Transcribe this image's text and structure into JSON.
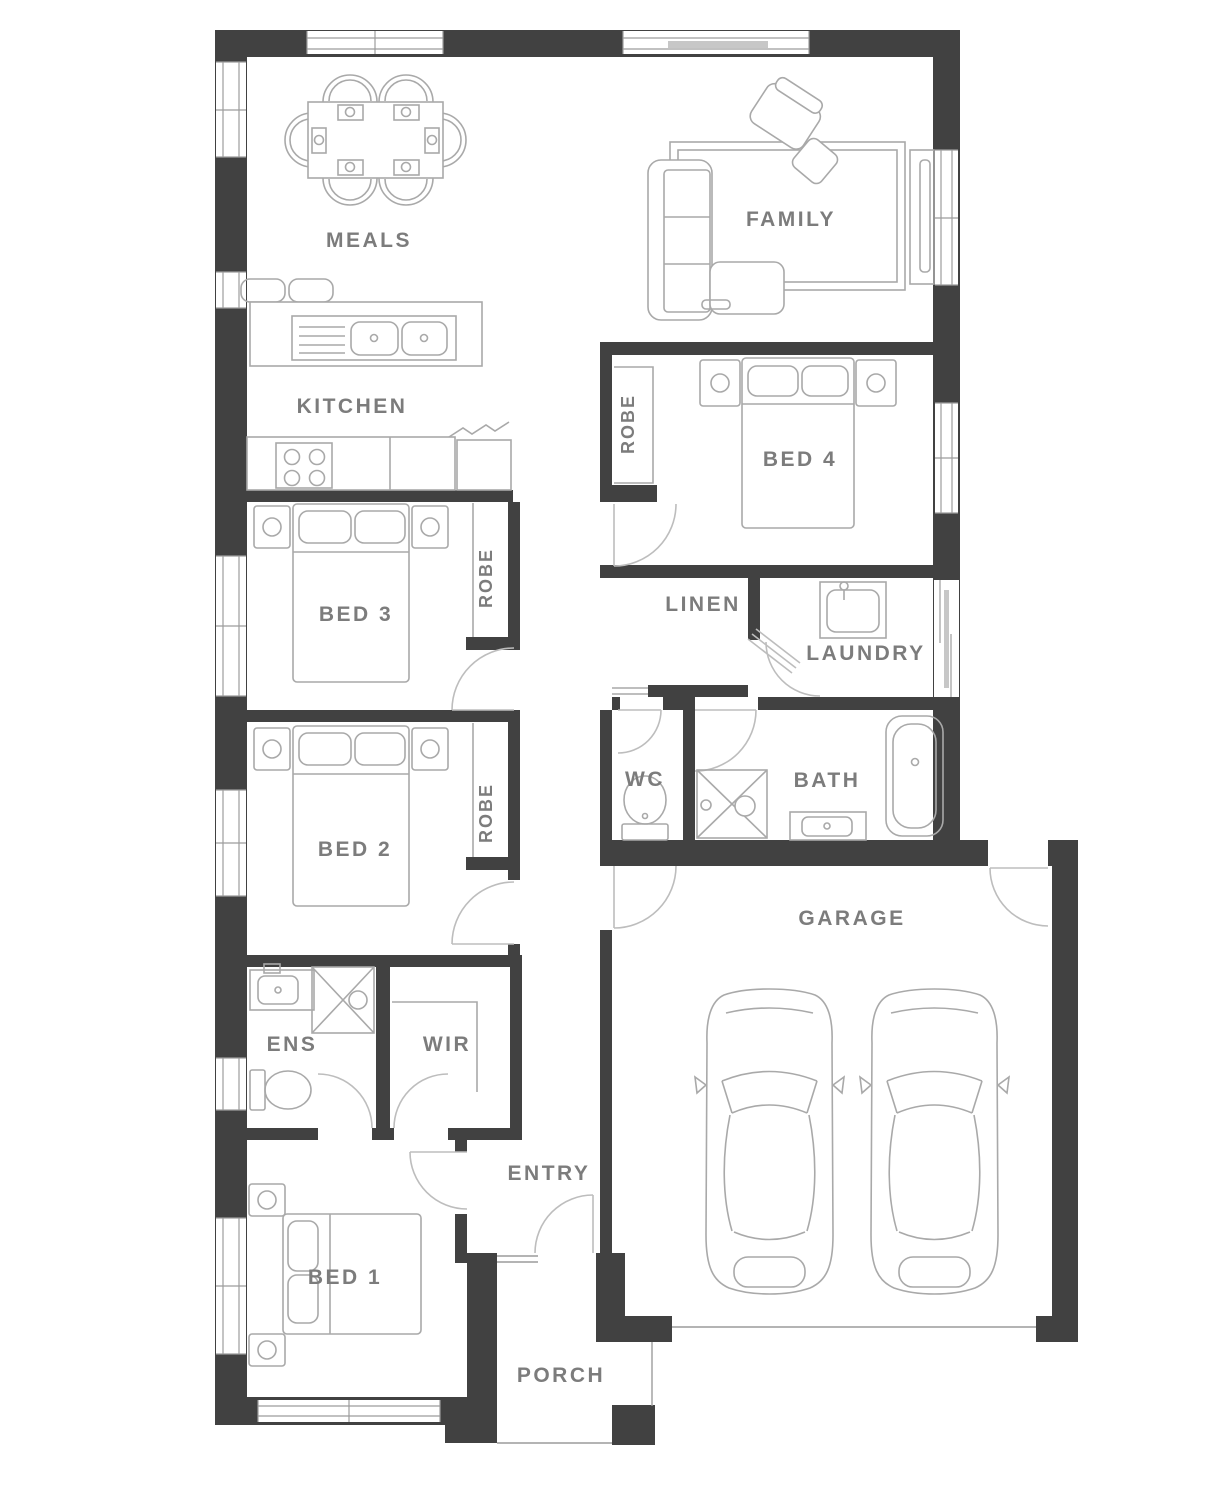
{
  "plan": {
    "rooms": {
      "meals": "MEALS",
      "family": "FAMILY",
      "kitchen": "KITCHEN",
      "bed4": "BED 4",
      "robe_bed4": "ROBE",
      "bed3": "BED 3",
      "robe_bed3": "ROBE",
      "linen": "LINEN",
      "laundry": "LAUNDRY",
      "bed2": "BED 2",
      "robe_bed2": "ROBE",
      "wc": "WC",
      "bath": "BATH",
      "garage": "GARAGE",
      "ens": "ENS",
      "wir": "WIR",
      "entry": "ENTRY",
      "bed1": "BED 1",
      "porch": "PORCH"
    },
    "colors": {
      "wall": "#414141",
      "label": "#7c7c7c",
      "furniture": "#a9a9a9",
      "door": "#bdbdbd",
      "line": "#9c9c9c",
      "bg": "#ffffff"
    }
  }
}
